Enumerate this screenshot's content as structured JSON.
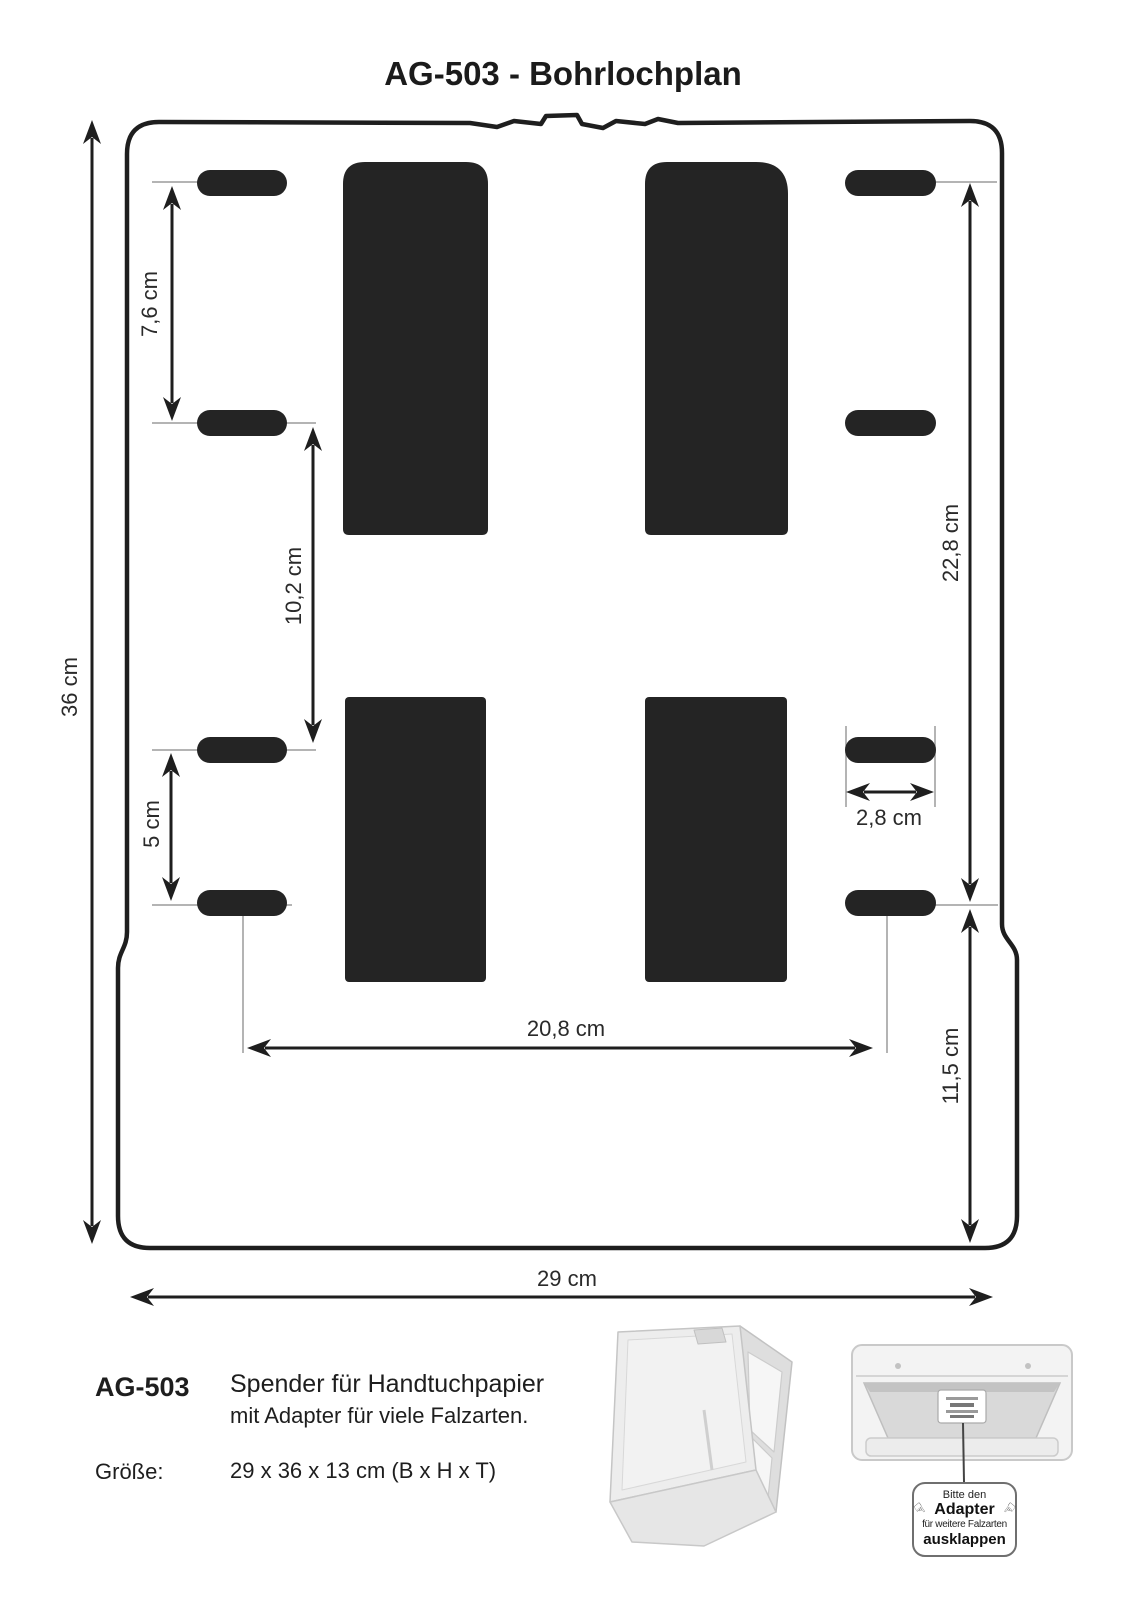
{
  "title": "AG-503 - Bohrlochplan",
  "dimensions": {
    "slot1_to_slot2": "7,6 cm",
    "slot2_to_slot3": "10,2 cm",
    "slot3_to_slot4": "5 cm",
    "total_height": "36 cm",
    "right_top_span": "22,8 cm",
    "slot_width": "2,8 cm",
    "horizontal_slot_span": "20,8 cm",
    "right_bottom_span": "11,5 cm",
    "total_width": "29 cm"
  },
  "product": {
    "model": "AG-503",
    "description_line1": "Spender für Handtuchpapier",
    "description_line2": "mit Adapter für viele Falzarten.",
    "size_label": "Größe:",
    "size_value": "29 x 36 x 13 cm (B x H x T)"
  },
  "note_box": {
    "line1": "Bitte den",
    "line2": "Adapter",
    "line3": "für weitere Falzarten",
    "line4": "ausklappen"
  },
  "colors": {
    "ink": "#1e1e1e",
    "cutout_fill": "#242424",
    "extension_line": "#9b9b9b"
  }
}
